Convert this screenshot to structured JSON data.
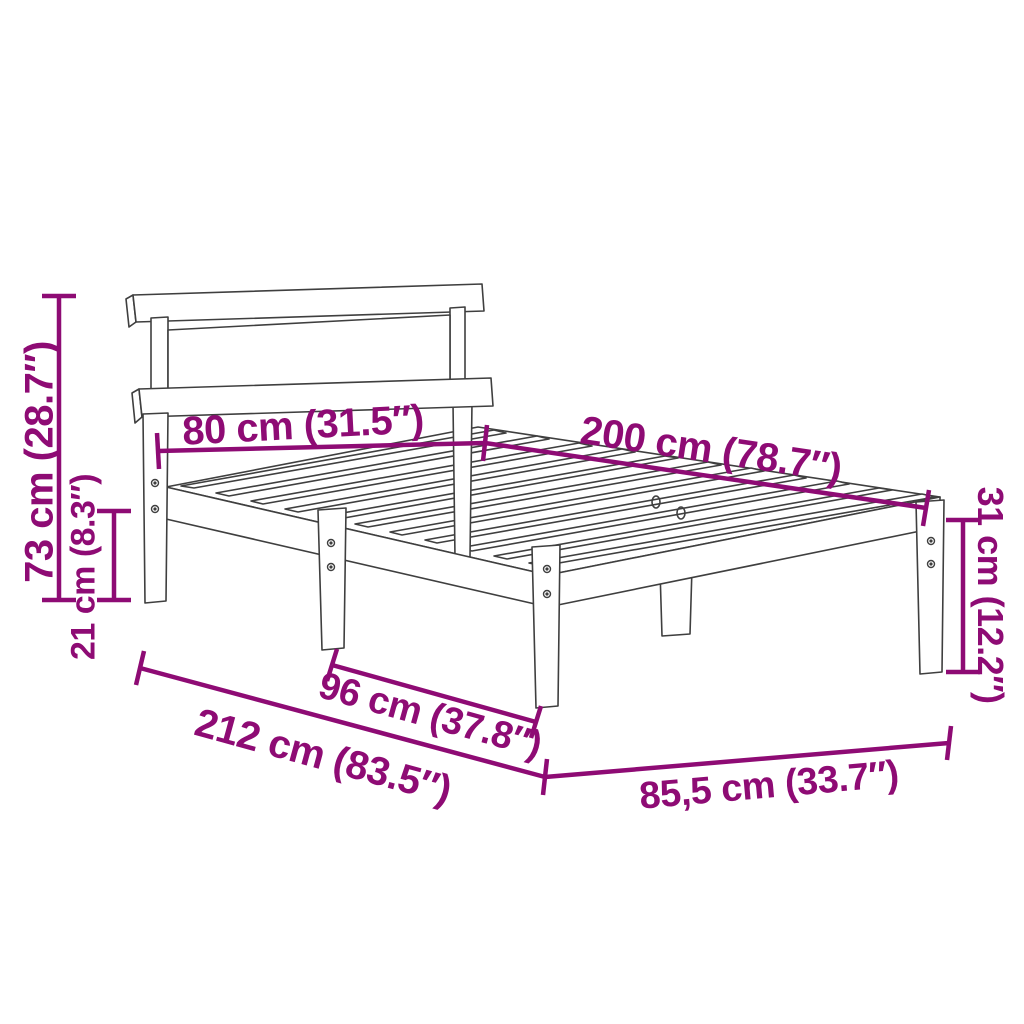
{
  "diagram": {
    "type": "product-dimension-diagram",
    "subject": "wooden bed frame with headboard and slatted base",
    "background_color": "#ffffff",
    "accent_color": "#8e0b74",
    "drawing_line_color": "#3f3f3f",
    "dimensions": [
      {
        "id": "headboard-height",
        "label": "73 cm (28.7″)",
        "value_cm": "73",
        "value_inch": "28.7",
        "orientation": "vertical-left"
      },
      {
        "id": "underbed-clearance",
        "label": "21 cm (8.3″)",
        "value_cm": "21",
        "value_inch": "8.3",
        "orientation": "vertical-left-inner"
      },
      {
        "id": "headboard-width",
        "label": "80 cm (31.5″)",
        "value_cm": "80",
        "value_inch": "31.5",
        "orientation": "horizontal-top-left"
      },
      {
        "id": "bed-length",
        "label": "200 cm (78.7″)",
        "value_cm": "200",
        "value_inch": "78.7",
        "orientation": "diagonal-top-right"
      },
      {
        "id": "frame-height",
        "label": "31 cm (12.2″)",
        "value_cm": "31",
        "value_inch": "12.2",
        "orientation": "vertical-right"
      },
      {
        "id": "leg-spacing",
        "label": "96 cm (37.8″)",
        "value_cm": "96",
        "value_inch": "37.8",
        "orientation": "diagonal-bottom-middle"
      },
      {
        "id": "total-length",
        "label": "212 cm (83.5″)",
        "value_cm": "212",
        "value_inch": "83.5",
        "orientation": "diagonal-bottom-left"
      },
      {
        "id": "total-width",
        "label": "85,5 cm (33.7″)",
        "value_cm": "85,5",
        "value_inch": "33.7",
        "orientation": "horizontal-bottom-right"
      }
    ],
    "parts": [
      "headboard-top-rail",
      "headboard-panel",
      "headboard-bottom-rail",
      "headboard-posts",
      "side-rail",
      "foot-rail",
      "slats",
      "legs",
      "screws"
    ]
  }
}
